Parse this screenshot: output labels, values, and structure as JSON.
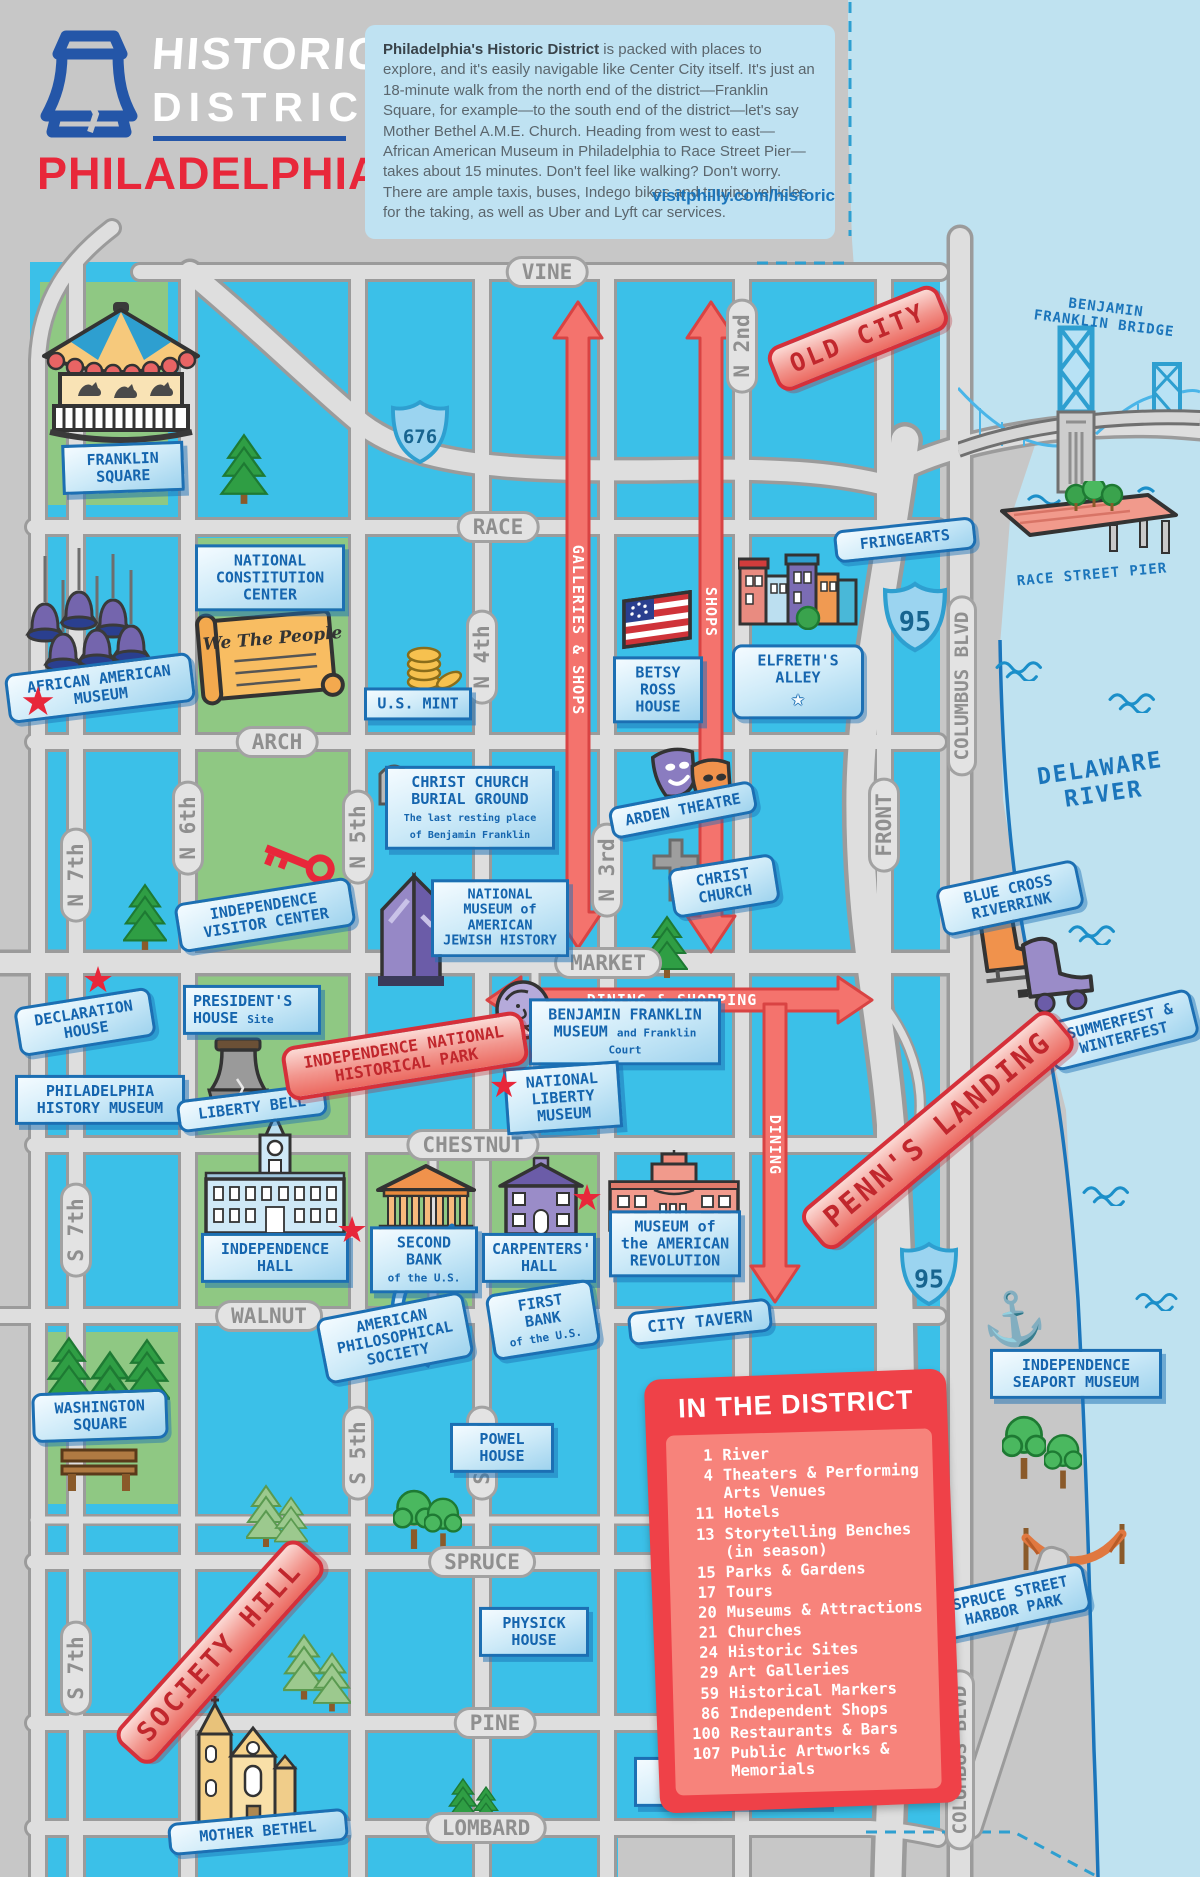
{
  "header": {
    "logo_title": "HISTORIC",
    "logo_subtitle": "DISTRICT",
    "logo_city": "PHILADELPHIA",
    "intro_lead": "Philadelphia's Historic District",
    "intro_body": " is packed with places to explore, and it's easily navigable like Center City itself. It's just an 18-minute walk from the north end of the district—Franklin Square, for example—to the south end of the district—let's say Mother Bethel A.M.E. Church. Heading from west to east—African American Museum in Philadelphia to Race Street Pier—takes about 15 minutes. Don't feel like walking? Don't worry. There are ample taxis, buses, Indego bikes and touring vehicles for the taking, as well as Uber and Lyft car services.",
    "url": "visitphilly.com/historic"
  },
  "streets": {
    "vine": "VINE",
    "race": "RACE",
    "arch": "ARCH",
    "market": "MARKET",
    "chestnut": "CHESTNUT",
    "walnut": "WALNUT",
    "spruce": "SPRUCE",
    "pine": "PINE",
    "lombard": "LOMBARD",
    "n7": "N 7th",
    "n6": "N 6th",
    "n5": "N 5th",
    "n4": "N 4th",
    "n3": "N 3rd",
    "n2": "N 2nd",
    "front": "FRONT",
    "columbus": "COLUMBUS BLVD",
    "s7": "S 7th",
    "s5": "S 5th",
    "s4": "S 4th"
  },
  "highways": {
    "i676": "676",
    "i95": "95"
  },
  "districts": {
    "old_city": "OLD CITY",
    "penns_landing": "PENN'S LANDING",
    "society_hill": "SOCIETY HILL",
    "historical_park": "INDEPENDENCE NATIONAL HISTORICAL PARK"
  },
  "arrows": {
    "galleries": "GALLERIES & SHOPS",
    "shops": "SHOPS",
    "dining_shopping": "DINING & SHOPPING",
    "dining": "DINING"
  },
  "landmarks": {
    "franklin_square": "FRANKLIN SQUARE",
    "constitution_center": "NATIONAL CONSTITUTION CENTER",
    "we_the_people": "We The People",
    "african_american_museum": "AFRICAN AMERICAN MUSEUM",
    "us_mint": "U.S. MINT",
    "betsy_ross": "BETSY ROSS HOUSE",
    "elfreths_alley": "ELFRETH'S ALLEY",
    "fringearts": "FRINGEARTS",
    "bf_bridge": "BENJAMIN FRANKLIN BRIDGE",
    "race_street_pier": "RACE STREET PIER",
    "burial_ground": "CHRIST CHURCH BURIAL GROUND",
    "burial_ground_sub": "The last resting place of Benjamin Franklin",
    "rip": "RIP",
    "arden_theatre": "ARDEN THEATRE",
    "christ_church": "CHRIST CHURCH",
    "visitor_center": "INDEPENDENCE VISITOR CENTER",
    "jewish_history": "NATIONAL MUSEUM of AMERICAN JEWISH HISTORY",
    "blue_cross_riverrink": "BLUE CROSS RIVERRINK",
    "summerfest": "SUMMERFEST & WINTERFEST",
    "declaration_house": "DECLARATION HOUSE",
    "presidents_house": "PRESIDENT'S HOUSE",
    "presidents_house_sub": "Site",
    "franklin_museum": "BENJAMIN FRANKLIN MUSEUM",
    "franklin_museum_sub": "and Franklin Court",
    "history_museum": "PHILADELPHIA HISTORY MUSEUM",
    "liberty_bell": "LIBERTY BELL",
    "liberty_museum": "NATIONAL LIBERTY MUSEUM",
    "independence_hall": "INDEPENDENCE HALL",
    "second_bank": "SECOND BANK",
    "of_the_us": "of the U.S.",
    "carpenters_hall": "CARPENTERS' HALL",
    "am_revolution": "MUSEUM of the AMERICAN REVOLUTION",
    "philosophical": "AMERICAN PHILOSOPHICAL SOCIETY",
    "first_bank": "FIRST BANK",
    "city_tavern": "CITY TAVERN",
    "seaport_museum": "INDEPENDENCE SEAPORT MUSEUM",
    "washington_square": "WASHINGTON SQUARE",
    "powel_house": "POWEL HOUSE",
    "physick_house": "PHYSICK HOUSE",
    "mother_bethel": "MOTHER BETHEL",
    "headhouse_pre": "The Shambles at",
    "headhouse": "HEADHOUSE SQUARE",
    "harbor_park": "SPRUCE STREET HARBOR PARK",
    "delaware_river": "DELAWARE RIVER"
  },
  "legend": {
    "title": "IN THE DISTRICT",
    "items": [
      {
        "count": "1",
        "label": "River"
      },
      {
        "count": "4",
        "label": "Theaters & Performing Arts Venues"
      },
      {
        "count": "11",
        "label": "Hotels"
      },
      {
        "count": "13",
        "label": "Storytelling Benches (in season)"
      },
      {
        "count": "15",
        "label": "Parks & Gardens"
      },
      {
        "count": "17",
        "label": "Tours"
      },
      {
        "count": "20",
        "label": "Museums & Attractions"
      },
      {
        "count": "21",
        "label": "Churches"
      },
      {
        "count": "24",
        "label": "Historic Sites"
      },
      {
        "count": "29",
        "label": "Art Galleries"
      },
      {
        "count": "59",
        "label": "Historical Markers"
      },
      {
        "count": "86",
        "label": "Independent Shops"
      },
      {
        "count": "100",
        "label": "Restaurants & Bars"
      },
      {
        "count": "107",
        "label": "Public Artworks & Memorials"
      }
    ]
  },
  "colors": {
    "accent_red": "#e8273a",
    "label_blue": "#1b75bb",
    "map_cyan": "#3bc0e8",
    "park_green": "#8fc883",
    "river_blue": "#bfe2f0"
  }
}
